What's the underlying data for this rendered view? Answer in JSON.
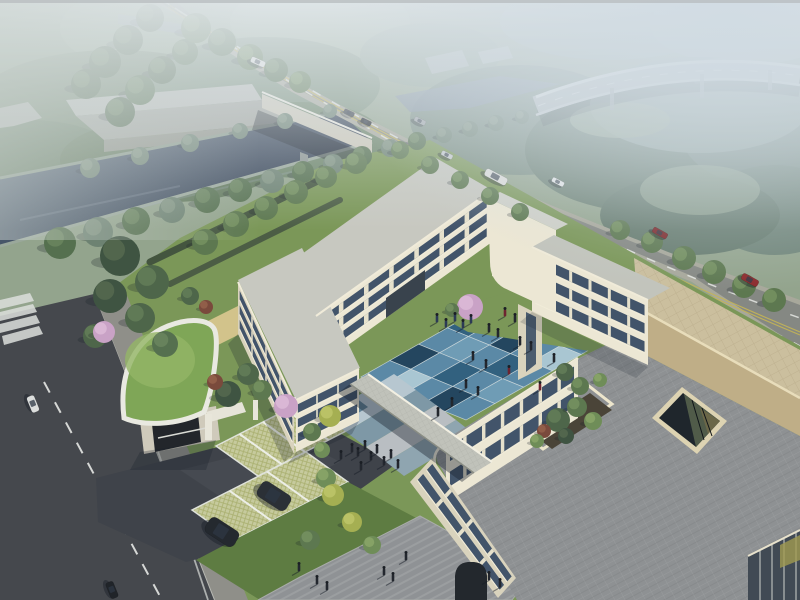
{
  "scene_label": "aerial-architectural-rendering-campus",
  "colors": {
    "sky_base": "#93a48d",
    "water": "#46556a",
    "water_far": "#7d8c9c",
    "road": "#858883",
    "road_verge": "#a8a89b",
    "left_road": "#45484d",
    "lane_white": "#e5e8e4",
    "lane_yellow": "#c3b457",
    "sidewalk": "#8f8f89",
    "wall_cream": "#ece7d4",
    "wall_shade": "#d9d3bd",
    "pier": "#e6e1cc",
    "window": "#42546a",
    "roof_light": "#c7c8c0",
    "roof_grey": "#8e9193",
    "raised_roof_beige": "#cbbf9e",
    "tan_wall": "#bfae87",
    "parapet": "#ece5cc",
    "lawn": "#7b9758",
    "lawn_deep": "#5e7c42",
    "green_roof": "#7fa657",
    "grass_paver": "#c6ca9d",
    "plaza": "#8f9295",
    "driveway": "#3f434a",
    "path_tan": "#d2c38b",
    "bridge": "#cdc9b9",
    "viaduct": "#b5bcbe",
    "warehouse": "#b4b7b2",
    "blossom": "#c9a2c6"
  },
  "courtyard": {
    "palette": [
      "#8fb3c6",
      "#5b89a6",
      "#32617f",
      "#a9c6d2",
      "#24465f",
      "#6f9cb5"
    ],
    "tiles": [
      [
        1,
        3,
        1,
        2,
        1
      ],
      [
        2,
        1,
        4,
        1,
        3
      ],
      [
        1,
        5,
        1,
        2,
        1
      ],
      [
        4,
        1,
        2,
        1,
        5
      ],
      [
        1,
        3,
        1,
        4,
        1
      ]
    ]
  },
  "trees": {
    "palette": [
      [
        "#3f5442",
        "#54684f"
      ],
      [
        "#4e664a",
        "#637c58"
      ],
      [
        "#5d7850",
        "#74905f"
      ],
      [
        "#6f8d58",
        "#88a468"
      ],
      [
        "#86a065",
        "#9fb677"
      ],
      [
        "#a5af52",
        "#bcc468"
      ],
      [
        "#c9a2c6",
        "#dbb9d6"
      ],
      [
        "#7a4a3c",
        "#94604a"
      ],
      [
        "#55704f",
        "#69845d"
      ],
      [
        "#6d8272",
        "#819482"
      ]
    ],
    "items": [
      [
        60,
        243,
        16,
        8
      ],
      [
        98,
        232,
        15,
        9
      ],
      [
        136,
        221,
        14,
        8
      ],
      [
        172,
        210,
        13,
        9
      ],
      [
        207,
        200,
        13,
        8
      ],
      [
        240,
        190,
        12,
        8
      ],
      [
        272,
        181,
        12,
        9
      ],
      [
        303,
        172,
        11,
        8
      ],
      [
        333,
        164,
        10,
        9
      ],
      [
        362,
        156,
        10,
        8
      ],
      [
        390,
        148,
        9,
        9
      ],
      [
        417,
        141,
        9,
        8
      ],
      [
        444,
        135,
        8,
        9
      ],
      [
        470,
        129,
        8,
        9
      ],
      [
        496,
        123,
        8,
        9
      ],
      [
        522,
        117,
        7,
        9
      ],
      [
        90,
        168,
        10,
        9
      ],
      [
        140,
        156,
        9,
        9
      ],
      [
        190,
        143,
        9,
        9
      ],
      [
        240,
        131,
        8,
        9
      ],
      [
        285,
        121,
        8,
        9
      ],
      [
        330,
        111,
        7,
        9
      ],
      [
        150,
        18,
        14,
        1
      ],
      [
        128,
        40,
        15,
        1
      ],
      [
        105,
        62,
        16,
        1
      ],
      [
        86,
        84,
        15,
        1
      ],
      [
        185,
        52,
        13,
        8
      ],
      [
        162,
        70,
        14,
        1
      ],
      [
        140,
        90,
        15,
        8
      ],
      [
        120,
        112,
        15,
        1
      ],
      [
        196,
        28,
        15,
        2
      ],
      [
        222,
        42,
        14,
        8
      ],
      [
        250,
        57,
        13,
        2
      ],
      [
        276,
        70,
        12,
        8
      ],
      [
        300,
        82,
        11,
        2
      ],
      [
        205,
        242,
        13,
        2
      ],
      [
        236,
        224,
        13,
        2
      ],
      [
        266,
        208,
        12,
        2
      ],
      [
        296,
        192,
        12,
        2
      ],
      [
        326,
        177,
        11,
        2
      ],
      [
        356,
        163,
        11,
        2
      ],
      [
        400,
        150,
        9,
        2
      ],
      [
        430,
        165,
        9,
        2
      ],
      [
        460,
        180,
        9,
        2
      ],
      [
        490,
        196,
        9,
        2
      ],
      [
        520,
        212,
        9,
        2
      ],
      [
        620,
        230,
        10,
        2
      ],
      [
        652,
        242,
        11,
        2
      ],
      [
        684,
        258,
        12,
        2
      ],
      [
        714,
        272,
        12,
        2
      ],
      [
        744,
        286,
        12,
        2
      ],
      [
        774,
        300,
        12,
        2
      ],
      [
        120,
        256,
        20,
        0
      ],
      [
        152,
        282,
        17,
        1
      ],
      [
        110,
        296,
        17,
        0
      ],
      [
        140,
        318,
        15,
        1
      ],
      [
        165,
        344,
        13,
        8
      ],
      [
        95,
        336,
        12,
        1
      ],
      [
        228,
        394,
        13,
        0
      ],
      [
        248,
        374,
        11,
        1
      ],
      [
        215,
        382,
        8,
        7
      ],
      [
        262,
        390,
        10,
        2
      ],
      [
        286,
        406,
        12,
        6
      ],
      [
        104,
        332,
        11,
        6
      ],
      [
        206,
        307,
        7,
        7
      ],
      [
        190,
        296,
        9,
        1
      ],
      [
        312,
        432,
        9,
        2
      ],
      [
        322,
        450,
        8,
        3
      ],
      [
        330,
        416,
        11,
        5
      ],
      [
        326,
        478,
        10,
        3
      ],
      [
        333,
        495,
        11,
        5
      ],
      [
        352,
        522,
        10,
        5
      ],
      [
        310,
        540,
        10,
        2
      ],
      [
        372,
        545,
        9,
        3
      ],
      [
        470,
        307,
        13,
        6
      ],
      [
        452,
        310,
        7,
        2
      ],
      [
        565,
        372,
        9,
        1
      ],
      [
        580,
        386,
        9,
        2
      ],
      [
        600,
        380,
        7,
        3
      ],
      [
        558,
        420,
        12,
        1
      ],
      [
        577,
        407,
        10,
        2
      ],
      [
        593,
        421,
        9,
        3
      ],
      [
        566,
        436,
        8,
        0
      ],
      [
        544,
        431,
        7,
        7
      ],
      [
        537,
        441,
        7,
        3
      ]
    ]
  },
  "forest": {
    "blobs": [
      [
        55,
        35,
        110,
        55,
        "#83987e"
      ],
      [
        190,
        28,
        130,
        50,
        "#8fa489"
      ],
      [
        320,
        22,
        90,
        40,
        "#99ac93"
      ],
      [
        115,
        105,
        140,
        55,
        "#70856b"
      ],
      [
        265,
        85,
        115,
        48,
        "#7b917b"
      ],
      [
        30,
        165,
        95,
        45,
        "#667d63"
      ],
      [
        170,
        160,
        110,
        42,
        "#5f7659"
      ],
      [
        300,
        140,
        85,
        38,
        "#6c8468"
      ],
      [
        430,
        55,
        70,
        32,
        "#8a9e8c"
      ],
      [
        520,
        120,
        110,
        55,
        "#788c7f"
      ],
      [
        645,
        150,
        120,
        62,
        "#6a7f71"
      ],
      [
        760,
        130,
        80,
        55,
        "#75897f"
      ],
      [
        610,
        22,
        110,
        38,
        "#97aaa1"
      ],
      [
        745,
        25,
        95,
        40,
        "#9fb1a9"
      ],
      [
        700,
        105,
        110,
        48,
        "#8a9d94"
      ],
      [
        775,
        210,
        70,
        45,
        "#6f8478"
      ],
      [
        690,
        215,
        90,
        40,
        "#667b6e"
      ]
    ],
    "meadows": [
      [
        150,
        120,
        60,
        22,
        "#a9bb8f"
      ],
      [
        260,
        140,
        40,
        16,
        "#a2b489"
      ],
      [
        80,
        200,
        50,
        18,
        "#9cb085"
      ],
      [
        700,
        190,
        60,
        25,
        "#8fa18d"
      ],
      [
        620,
        120,
        50,
        18,
        "#95a890"
      ]
    ]
  },
  "vehicles": {
    "road_cars": [
      [
        258,
        62,
        15,
        6,
        24,
        "#e6e6e2"
      ],
      [
        349,
        113,
        11,
        5,
        26,
        "#3c424a"
      ],
      [
        366,
        122,
        11,
        5,
        26,
        "#21262c"
      ],
      [
        420,
        121,
        12,
        5,
        27,
        "#9fa4a8"
      ],
      [
        447,
        155,
        12,
        5,
        27,
        "#c6cacc"
      ],
      [
        496,
        177,
        24,
        8,
        28,
        "#dfdfdb"
      ],
      [
        558,
        182,
        13,
        5,
        28,
        "#e8eaea"
      ],
      [
        660,
        233,
        16,
        6,
        29,
        "#7c2628"
      ],
      [
        750,
        280,
        18,
        7,
        29,
        "#8c2a2c"
      ]
    ],
    "parked_suvs": [
      [
        274,
        496,
        34,
        18,
        33,
        "#2b3036"
      ],
      [
        222,
        532,
        34,
        18,
        33,
        "#24292f"
      ]
    ],
    "local_cars": [
      [
        33,
        404,
        17,
        8,
        68,
        "#dcdedd"
      ],
      [
        112,
        590,
        17,
        8,
        68,
        "#202429"
      ]
    ]
  },
  "people": {
    "courtyard_dark": {
      "color": "#23272e",
      "items": [
        [
          489,
          332
        ],
        [
          498,
          337
        ],
        [
          520,
          345
        ],
        [
          531,
          350
        ],
        [
          473,
          360
        ],
        [
          486,
          368
        ],
        [
          466,
          388
        ],
        [
          478,
          395
        ],
        [
          452,
          406
        ],
        [
          438,
          416
        ],
        [
          554,
          362
        ],
        [
          515,
          322
        ]
      ]
    },
    "courtyard_red": {
      "color": "#6e2430",
      "items": [
        [
          509,
          374
        ],
        [
          540,
          390
        ],
        [
          505,
          316
        ]
      ]
    },
    "north_path": {
      "color": "#2c3a55",
      "items": [
        [
          437,
          322
        ],
        [
          446,
          327
        ],
        [
          455,
          321
        ],
        [
          463,
          328
        ],
        [
          471,
          323
        ]
      ]
    },
    "exercise": {
      "color": "#23272e",
      "items": [
        [
          352,
          452
        ],
        [
          358,
          456
        ],
        [
          365,
          449
        ],
        [
          371,
          460
        ],
        [
          377,
          453
        ],
        [
          384,
          465
        ],
        [
          391,
          458
        ],
        [
          398,
          468
        ],
        [
          341,
          459
        ],
        [
          361,
          470
        ]
      ]
    },
    "plaza": {
      "color": "#23272e",
      "items": [
        [
          317,
          584
        ],
        [
          327,
          590
        ],
        [
          384,
          575
        ],
        [
          393,
          581
        ],
        [
          406,
          560
        ],
        [
          489,
          580
        ],
        [
          500,
          587
        ],
        [
          299,
          571
        ]
      ]
    }
  }
}
